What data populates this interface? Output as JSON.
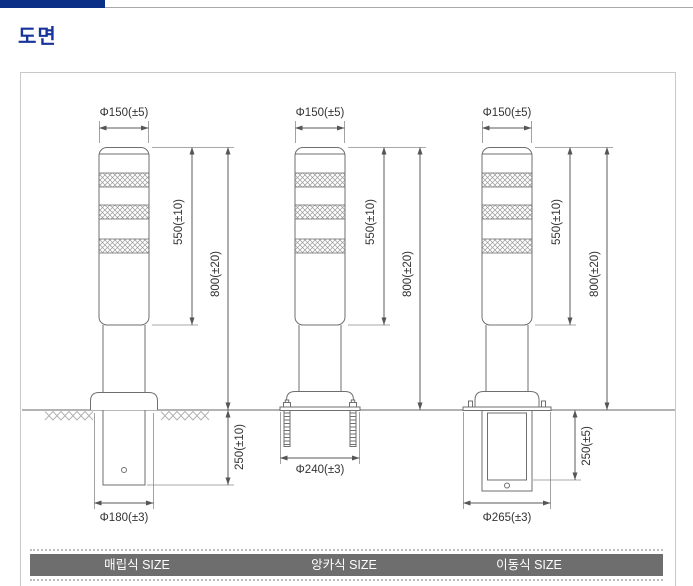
{
  "header": {
    "title": "도면"
  },
  "drawings": {
    "buried": {
      "label": "매립식 SIZE",
      "top_diameter": "Φ150(±5)",
      "stripe_section_height": "550(±10)",
      "above_ground_height": "800(±20)",
      "embed_depth": "250(±10)",
      "base_diameter": "Φ180(±3)"
    },
    "anchor": {
      "label": "앙카식 SIZE",
      "top_diameter": "Φ150(±5)",
      "stripe_section_height": "550(±10)",
      "above_ground_height": "800(±20)",
      "base_diameter": "Φ240(±3)"
    },
    "movable": {
      "label": "이동식 SIZE",
      "top_diameter": "Φ150(±5)",
      "stripe_section_height": "550(±10)",
      "above_ground_height": "800(±20)",
      "embed_depth": "250(±5)",
      "base_diameter": "Φ265(±3)"
    }
  },
  "colors": {
    "accent_navy": "#0b2e87",
    "title_blue": "#17339c",
    "footer_bar_gray": "#6e6e6e",
    "drawing_line": "#6f6f6f",
    "dimension_line": "#5a5a5a",
    "ground_line": "#9a9a9a"
  }
}
